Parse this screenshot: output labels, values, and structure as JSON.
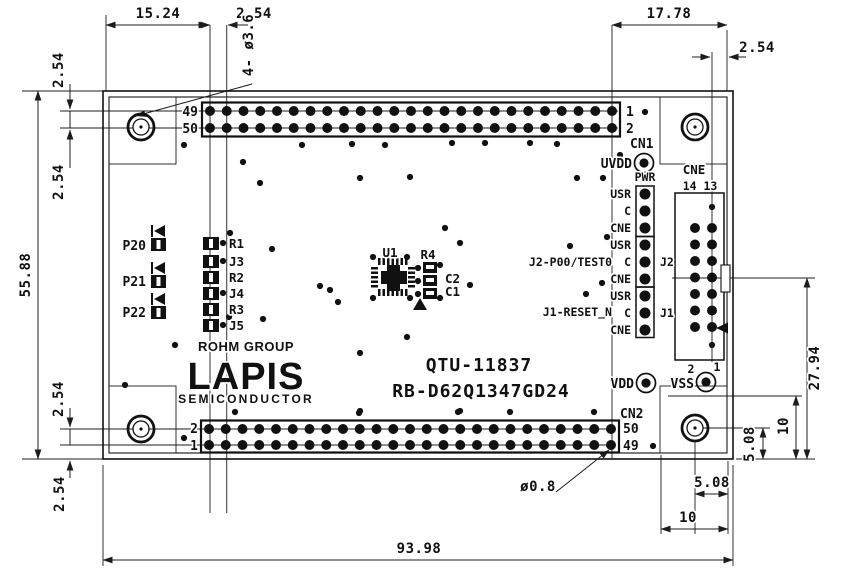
{
  "colors": {
    "ink": "#111111",
    "background": "#ffffff"
  },
  "drawing": {
    "board_title_1": "QTU-11837",
    "board_title_2": "RB-D62Q1347GD24",
    "logo": {
      "group": "ROHM GROUP",
      "brand": "LAPIS",
      "sub": "SEMICONDUCTOR"
    },
    "dims": {
      "w_edge_to_cn1": "15.24",
      "pitch_top": "2.54",
      "w_cn1_to_edge": "17.78",
      "w_cne_to_edge": "2.54",
      "h_edge_to_row49": "2.54",
      "h_row49_to_row50": "2.54",
      "board_h": "55.88",
      "h_row2_to_row1": "2.54",
      "h_row1_to_edge": "2.54",
      "board_w": "93.98",
      "h_cne_row_to_edge": "27.94",
      "corner_v": "10",
      "hole_v": "5.08",
      "hole_h": "5.08",
      "corner_h": "10",
      "mount_note": "4- ø3.6",
      "via_note": "ø0.8"
    },
    "cn1": {
      "name": "CN1",
      "left_top": "49",
      "left_bot": "50",
      "right_top": "1",
      "right_bot": "2",
      "cols": 25
    },
    "cn2": {
      "name": "CN2",
      "left_top": "2",
      "left_bot": "1",
      "right_top": "50",
      "right_bot": "49",
      "cols": 25
    },
    "cne": {
      "name": "CNE",
      "pins_label": "14 13",
      "rows": 7
    },
    "power": {
      "uvdd": "UVDD",
      "pwr": "PWR",
      "vdd": "VDD",
      "vss": "VSS",
      "vss_pin2": "2",
      "vss_pin1": "1"
    },
    "jumpers": {
      "row_labels": [
        "USR",
        "C",
        "CNE",
        "USR",
        "C",
        "CNE",
        "USR",
        "C",
        "CNE"
      ],
      "j2": "J2",
      "j1": "J1",
      "j2_signal": "J2-P00/TEST0",
      "j1_signal": "J1-RESET_N"
    },
    "left_components": {
      "ports": [
        "P20",
        "P21",
        "P22"
      ],
      "parts": [
        "R1",
        "J3",
        "R2",
        "J4",
        "R3",
        "J5"
      ]
    },
    "center": {
      "u1": "U1",
      "r4": "R4",
      "c2": "C2",
      "c1": "C1"
    },
    "vias": [
      [
        184,
        145
      ],
      [
        243,
        162
      ],
      [
        302,
        145
      ],
      [
        352,
        144
      ],
      [
        385,
        145
      ],
      [
        452,
        143
      ],
      [
        485,
        143
      ],
      [
        530,
        143
      ],
      [
        557,
        144
      ],
      [
        620,
        155
      ],
      [
        645,
        112
      ],
      [
        260,
        183
      ],
      [
        360,
        178
      ],
      [
        410,
        177
      ],
      [
        577,
        178
      ],
      [
        603,
        178
      ],
      [
        230,
        233
      ],
      [
        272,
        249
      ],
      [
        320,
        286
      ],
      [
        330,
        290
      ],
      [
        229,
        317
      ],
      [
        263,
        319
      ],
      [
        175,
        345
      ],
      [
        373,
        257
      ],
      [
        407,
        257
      ],
      [
        445,
        228
      ],
      [
        460,
        243
      ],
      [
        470,
        285
      ],
      [
        373,
        298
      ],
      [
        410,
        298
      ],
      [
        338,
        302
      ],
      [
        407,
        337
      ],
      [
        570,
        246
      ],
      [
        607,
        237
      ],
      [
        602,
        283
      ],
      [
        586,
        294
      ],
      [
        125,
        385
      ],
      [
        235,
        412
      ],
      [
        359,
        413
      ],
      [
        458,
        412
      ],
      [
        360,
        353
      ],
      [
        360,
        411
      ],
      [
        460,
        411
      ],
      [
        510,
        412
      ],
      [
        594,
        412
      ],
      [
        184,
        438
      ],
      [
        653,
        446
      ],
      [
        223,
        243
      ],
      [
        223,
        261
      ],
      [
        223,
        293
      ],
      [
        223,
        325
      ],
      [
        418,
        268
      ],
      [
        418,
        281
      ],
      [
        418,
        294
      ],
      [
        440,
        265
      ],
      [
        440,
        298
      ],
      [
        712,
        207
      ],
      [
        712,
        345
      ]
    ]
  }
}
